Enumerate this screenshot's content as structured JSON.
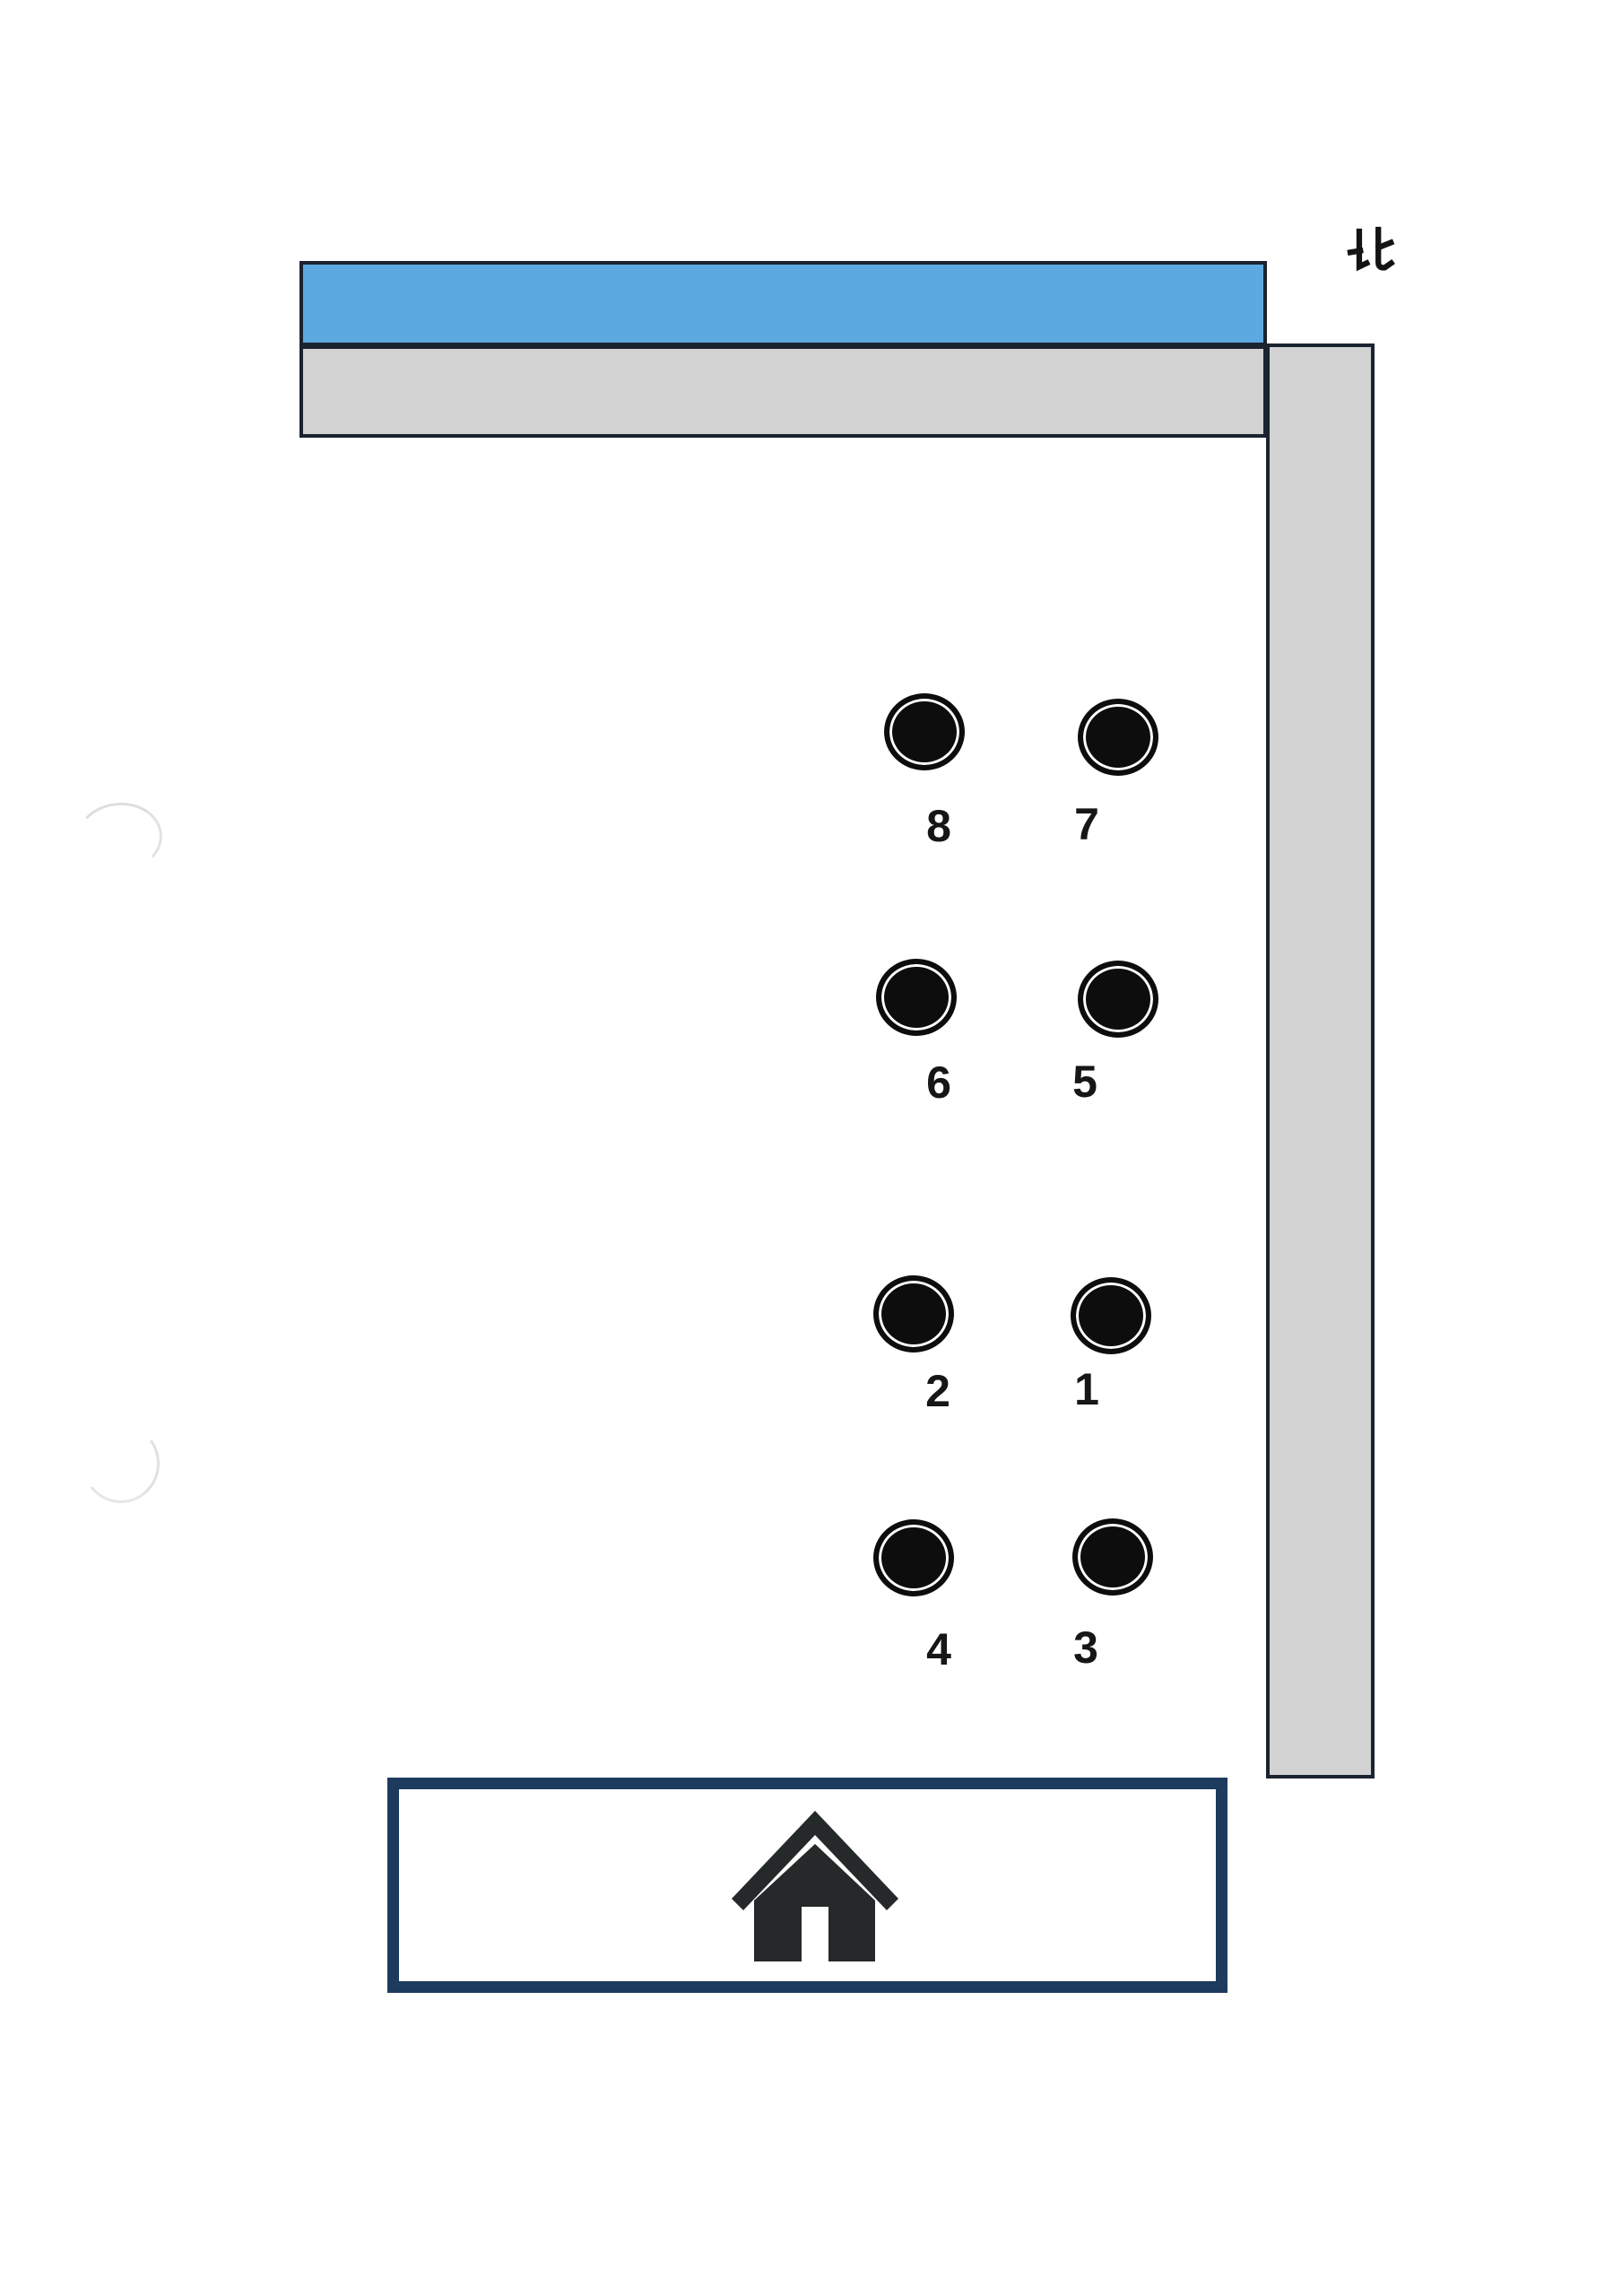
{
  "compass": {
    "label": "北"
  },
  "colors": {
    "water_blue": "#5ca8e0",
    "road_gray": "#d2d2d2",
    "strip_outline_dark": "#1a2430",
    "house_frame_navy": "#1d3b5c",
    "house_icon_dark": "#26292a",
    "marker_black": "#0d0d0d"
  },
  "markers": [
    {
      "label": "8"
    },
    {
      "label": "7"
    },
    {
      "label": "6"
    },
    {
      "label": "5"
    },
    {
      "label": "2"
    },
    {
      "label": "1"
    },
    {
      "label": "4"
    },
    {
      "label": "3"
    }
  ]
}
